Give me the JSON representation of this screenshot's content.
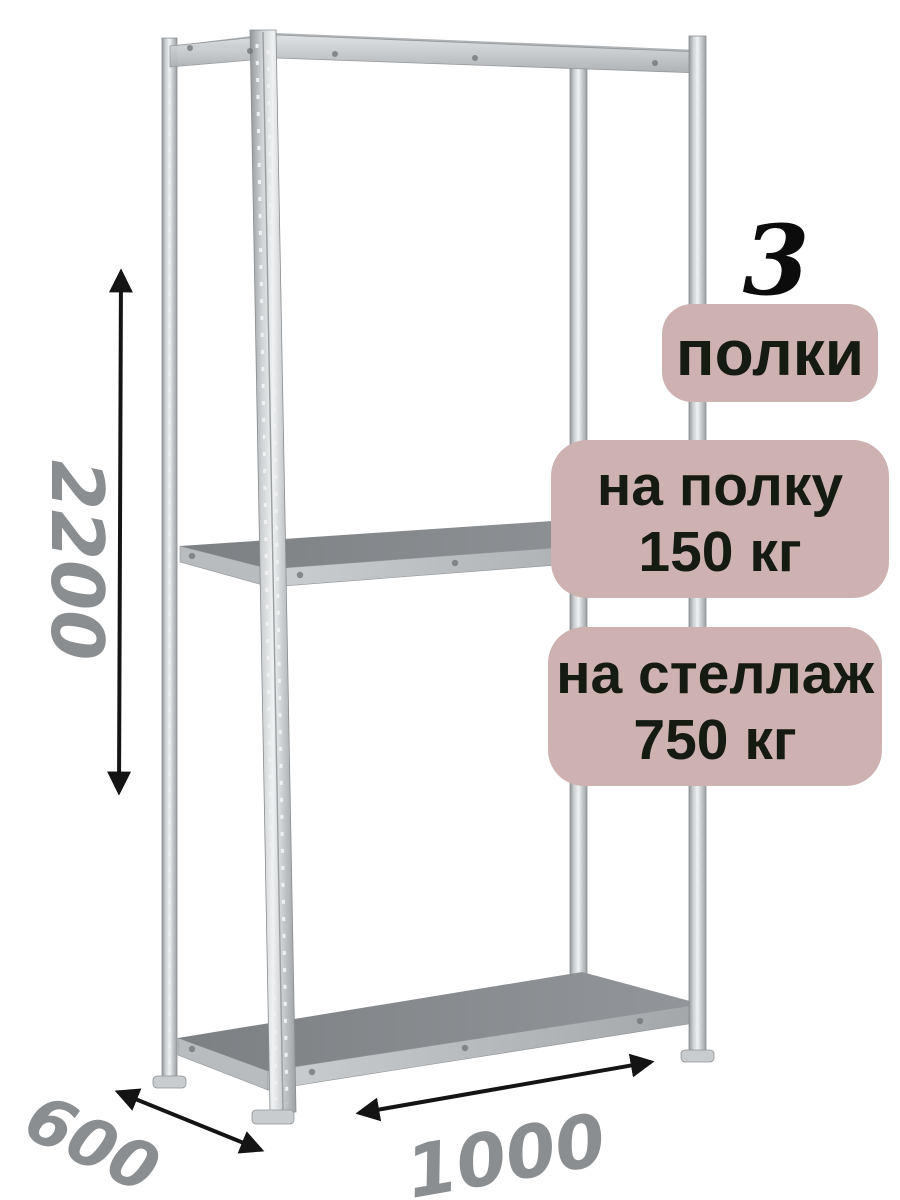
{
  "page": {
    "background": "#ffffff"
  },
  "badges": {
    "count": "3",
    "count_label": "полки",
    "per_shelf": {
      "line1": "на полку",
      "line2": "150 кг"
    },
    "per_rack": {
      "line1": "на стеллаж",
      "line2": "750 кг"
    },
    "bg_color": "#cdb2b1",
    "text_color": "#151a13",
    "count_color": "#0c0c0c"
  },
  "dimensions": {
    "height": "2200",
    "depth": "600",
    "width": "1000",
    "label_color": "#8b8e90",
    "arrow_color": "#141414"
  },
  "rack_colors": {
    "shelf_top": "#85898c",
    "shelf_face": "#b8bcbf",
    "metal_post": "#c7cbce"
  }
}
